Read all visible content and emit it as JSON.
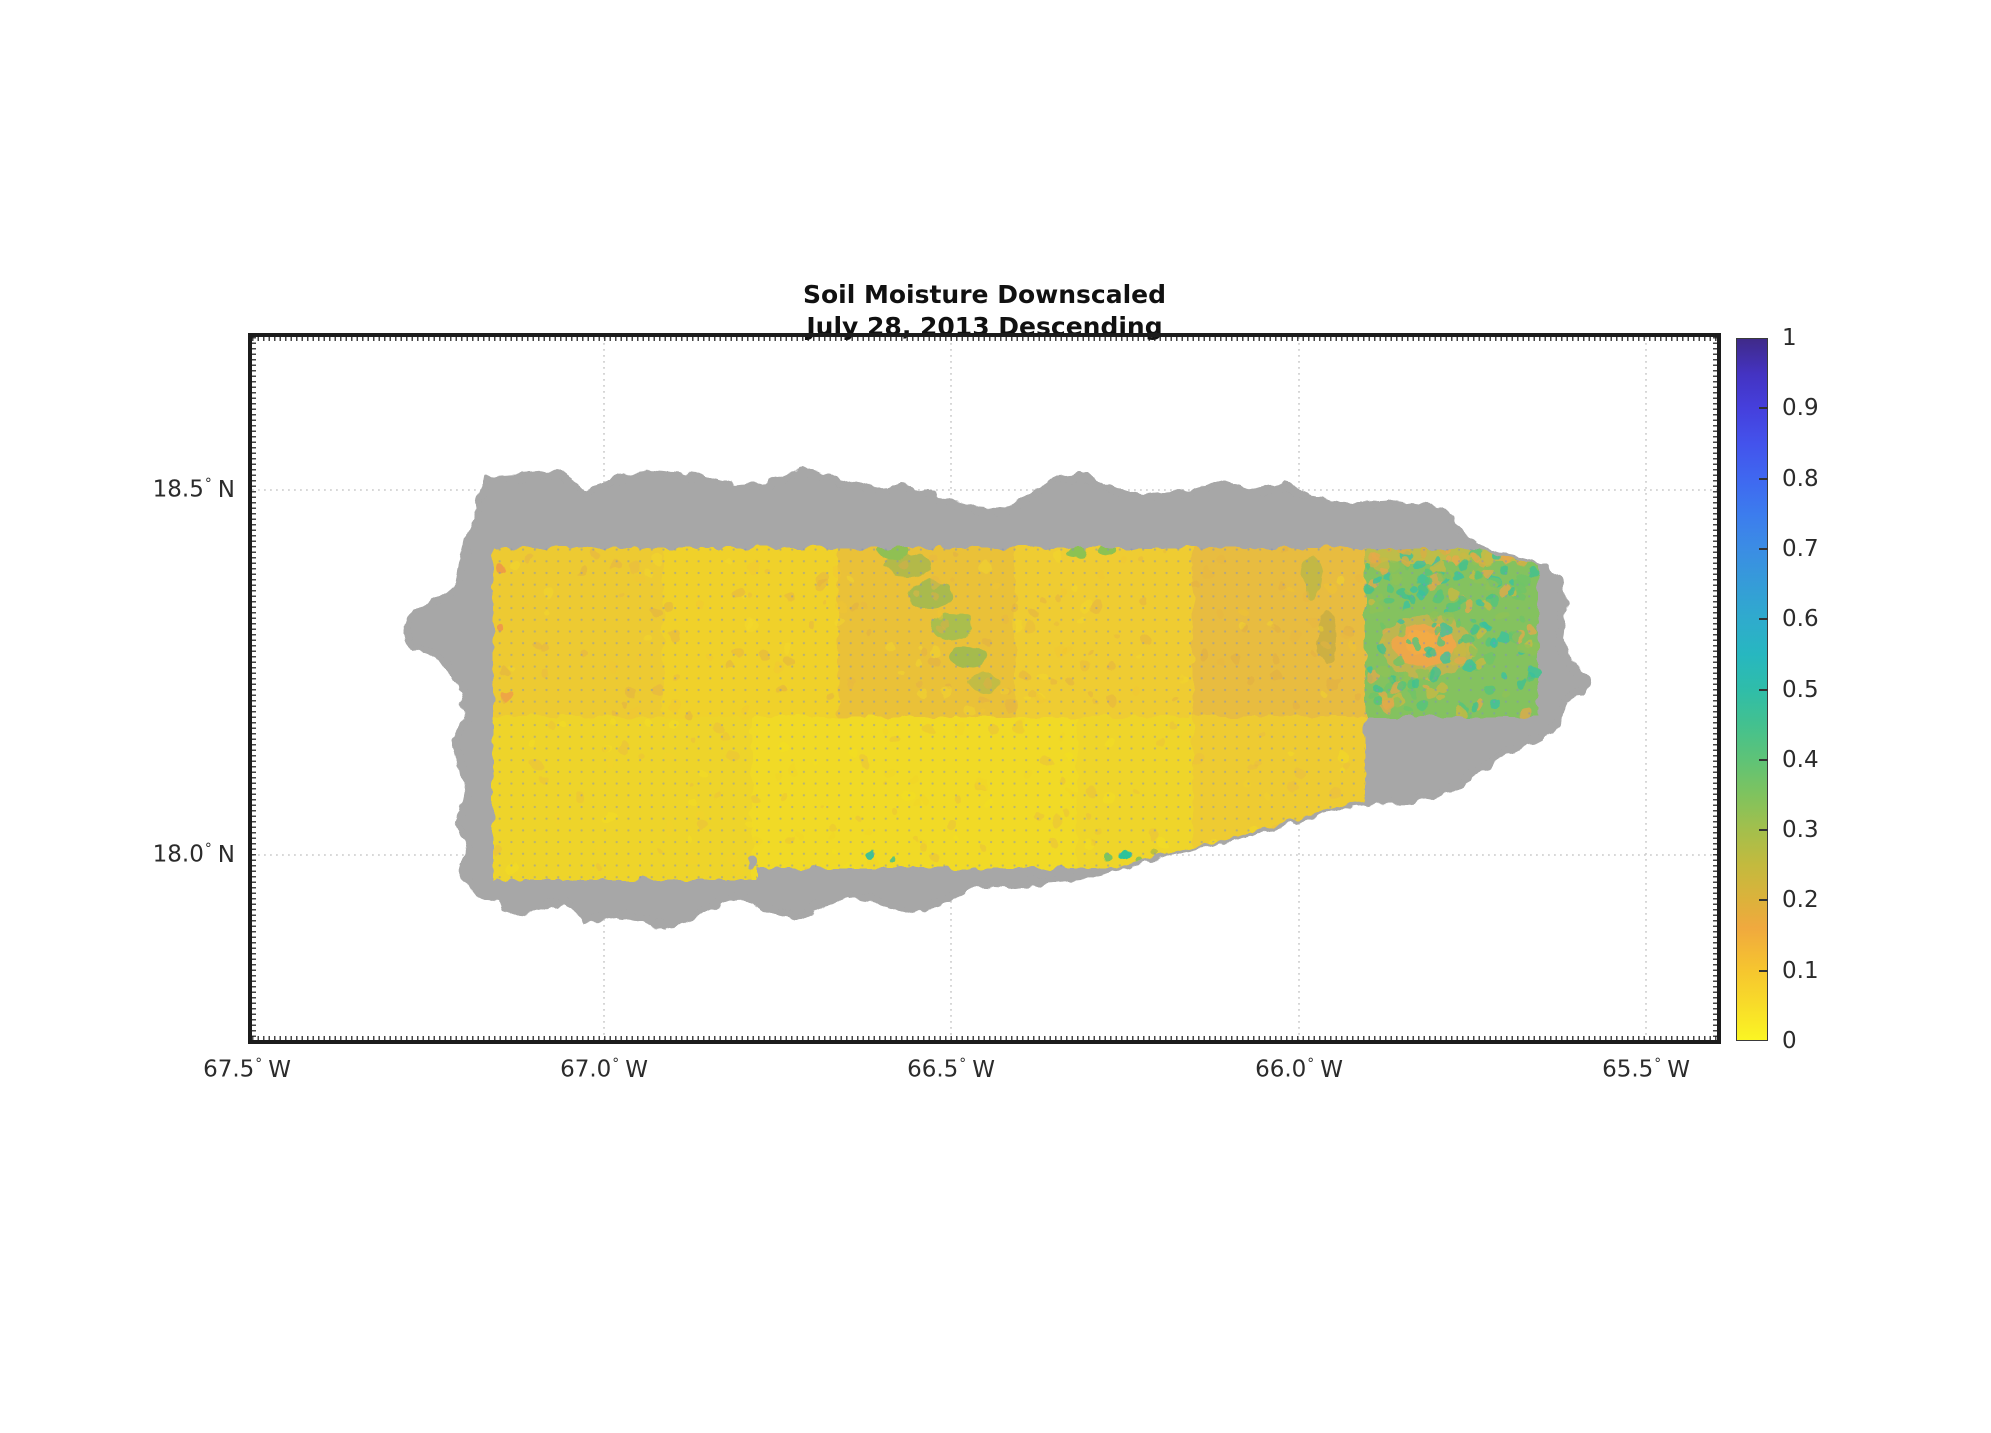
{
  "title": {
    "line1": "Soil Moisture Downscaled",
    "line2": "July 28, 2013 Descending"
  },
  "axes": {
    "degree_symbol": "°",
    "x_ticks": [
      {
        "value": "67.5",
        "dir": "W"
      },
      {
        "value": "67.0",
        "dir": "W"
      },
      {
        "value": "66.5",
        "dir": "W"
      },
      {
        "value": "66.0",
        "dir": "W"
      },
      {
        "value": "65.5",
        "dir": "W"
      }
    ],
    "y_ticks": [
      {
        "value": "18.5",
        "dir": "N"
      },
      {
        "value": "18.0",
        "dir": "N"
      }
    ]
  },
  "colorbar": {
    "tick_labels": [
      "1",
      "0.9",
      "0.8",
      "0.7",
      "0.6",
      "0.5",
      "0.4",
      "0.3",
      "0.2",
      "0.1",
      "0"
    ]
  },
  "colors": {
    "no_data_gray": "#a7a7a7",
    "background": "#ffffff",
    "axis": "#1c1c1c",
    "gridline": "#cccccc",
    "low_yellow": "#f7f32a",
    "orange": "#f0a93e",
    "olive": "#c3ba3e",
    "green": "#5ec377",
    "teal": "#2fbda9",
    "high_blue": "#3f2a89"
  },
  "chart_data": {
    "type": "heatmap",
    "title": "Soil Moisture Downscaled",
    "subtitle": "July 28, 2013 Descending",
    "region_shown": "Puerto Rico",
    "x_axis": {
      "tick_labels": [
        "67.5° W",
        "67.0° W",
        "66.5° W",
        "66.0° W",
        "65.5° W"
      ],
      "range_deg_west": [
        67.5,
        65.44
      ],
      "gridlines_deg_west": [
        67.0,
        66.5,
        66.0,
        65.5
      ]
    },
    "y_axis": {
      "tick_labels": [
        "18.5° N",
        "18.0° N"
      ],
      "range_deg_north": [
        17.76,
        18.71
      ],
      "gridlines_deg_north": [
        18.5,
        18.0
      ]
    },
    "colorbar": {
      "range": [
        0,
        1
      ],
      "ticks": [
        0,
        0.1,
        0.2,
        0.3,
        0.4,
        0.5,
        0.6,
        0.7,
        0.8,
        0.9,
        1
      ],
      "colormap": "yellow (0) through orange ~0.17, olive ~0.3, green 0.4, teal 0.5-0.6, blue 0.7-0.8, dark violet-blue (1)"
    },
    "observations": [
      {
        "area": "main downscaled grid covering western/central Puerto Rico (~67.15-65.91 W, ~17.96-18.42 N)",
        "soil_moisture_range": [
          0.02,
          0.2
        ],
        "appearance": "yellow with orange patches; brighter yellow band in the southern half"
      },
      {
        "area": "north-central diagonal streak (~66.55 W)",
        "soil_moisture_range": [
          0.2,
          0.35
        ],
        "appearance": "olive-green streak"
      },
      {
        "area": "eastern block (~65.91-65.67 W, 18.21-18.42 N, El Yunque area)",
        "soil_moisture_range": [
          0.25,
          0.55
        ],
        "appearance": "green/teal speckled with a central orange patch ~0.15"
      },
      {
        "area": "island fringe outside the downscaled grid",
        "soil_moisture_range": null,
        "appearance": "gray (no data)"
      }
    ],
    "grid": "dotted graticule; fine dotted minor grid over data region"
  }
}
